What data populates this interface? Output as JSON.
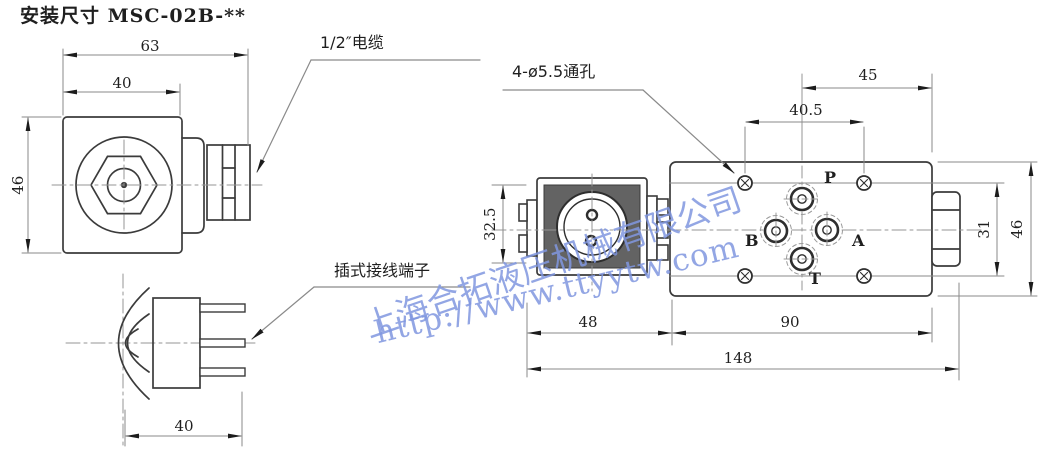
{
  "title": "安装尺寸 MSC-02B-**",
  "watermark": {
    "company": "上海合拓液压机械有限公司",
    "url": "http://www.ttyytw.com",
    "color": "#8096df"
  },
  "colors": {
    "outline": "#3b3b3b",
    "dim_line": "#8a8a8a",
    "text": "#1f1f1f",
    "knurl_fill": "#636363"
  },
  "front_view": {
    "dim_width_outer": "63",
    "dim_width_coil": "40",
    "dim_height": "46",
    "cable_label": "1/2″电缆"
  },
  "side_view": {
    "dim_width": "40",
    "terminal_label": "插式接线端子"
  },
  "top_view": {
    "hole_label": "4-ø5.5通孔",
    "dim_right": "45",
    "dim_hole_x": "40.5",
    "dim_coil_h": "32.5",
    "dim_hole_y": "31",
    "dim_body_h": "46",
    "dim_coil_len": "48",
    "dim_body_len": "90",
    "dim_total_len": "148",
    "port_p": "P",
    "port_a": "A",
    "port_b": "B",
    "port_t": "T"
  }
}
